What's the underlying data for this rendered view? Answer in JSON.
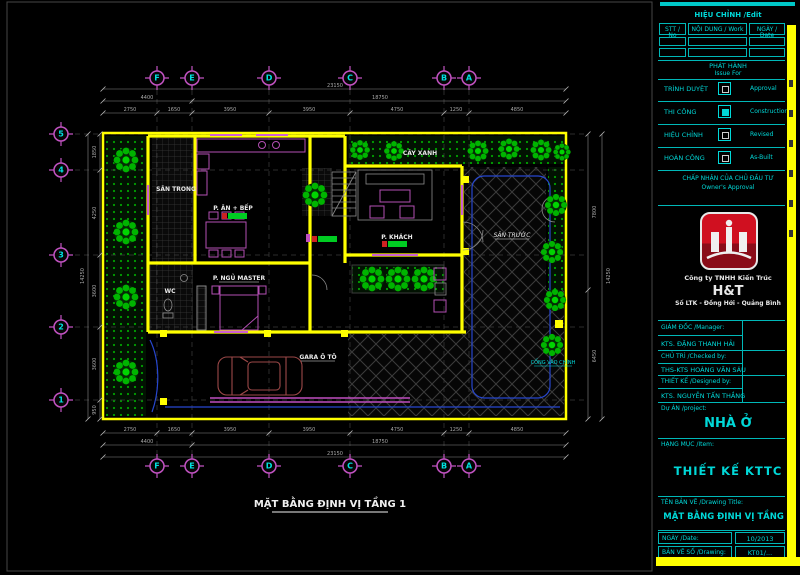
{
  "titleblock": {
    "edit_header": "HIỆU CHỈNH /Edit",
    "table": {
      "headers": [
        "STT / No",
        "NỘI DUNG / Work",
        "NGÀY / Date"
      ]
    },
    "issue": {
      "vi": "PHÁT HÀNH",
      "en": "Issue For"
    },
    "issue_rows": [
      {
        "vi": "TRÌNH DUYỆT",
        "en": "Approval"
      },
      {
        "vi": "THI CÔNG",
        "en": "Construction"
      },
      {
        "vi": "HIỆU CHỈNH",
        "en": "Revised"
      },
      {
        "vi": "HOÀN CÔNG",
        "en": "As-Built"
      }
    ],
    "approval": {
      "vi": "CHẤP NHẬN CỦA CHỦ ĐẦU TƯ",
      "en": "Owner's Approval"
    },
    "company": {
      "line1": "Công ty TNHH Kiến Trúc",
      "brand": "H&T",
      "line2": "Số LTK - Đồng Hới - Quảng Bình"
    },
    "staff": [
      {
        "role": "GIÁM ĐỐC /Manager:",
        "name": "KTS. ĐẶNG THANH HẢI"
      },
      {
        "role": "CHỦ TRÌ /Checked by:",
        "name": "THS-KTS HOÀNG VĂN SÁU"
      },
      {
        "role": "THIẾT KẾ /Designed by:",
        "name": "KTS. NGUYỄN TẤN THẮNG"
      }
    ],
    "project": {
      "label": "Dự ÁN /project:",
      "value": "NHÀ Ở"
    },
    "item": {
      "label": "HẠNG MỤC /Item:",
      "value": "THIẾT KẾ KTTC"
    },
    "drawing": {
      "label": "TÊN BẢN VẼ /Drawing Title:",
      "value": "MẶT BẰNG ĐỊNH VỊ TẦNG 1"
    },
    "date": {
      "label": "NGÀY /Date:",
      "value": "10/2013"
    },
    "number": {
      "label": "BẢN VẼ SỐ /Drawing:",
      "value": "KT01/..."
    }
  },
  "plan": {
    "caption": "MẶT BẰNG ĐỊNH VỊ TẦNG 1",
    "grid_cols": [
      "F",
      "E",
      "D",
      "C",
      "B",
      "A"
    ],
    "grid_rows": [
      "5",
      "4",
      "3",
      "2",
      "1"
    ],
    "labels": {
      "kitchen": "P. ĂN + BẾP",
      "living": "P. KHÁCH",
      "bedroom": "P. NGỦ MASTER",
      "wc": "WC",
      "garage": "GARA Ô TÔ",
      "front_yard": "SÂN TRƯỚC",
      "inner_yard": "SÂN TRONG",
      "greenery": "CÂY XANH",
      "main_gate": "CỔNG VÀO CHÍNH"
    },
    "dims": {
      "top_bays": [
        "2750",
        "1650",
        "3950",
        "3950",
        "4750",
        "1250",
        "4850"
      ],
      "top_mid": [
        "4400",
        "18750"
      ],
      "top_total": "23150",
      "left_bays": [
        "1850",
        "4250",
        "3600",
        "3600",
        "950"
      ],
      "left_total": "14250",
      "right_segs": [
        "7800",
        "6450"
      ],
      "right_total": "14250"
    }
  },
  "colors": {
    "accent_cyan": "#00d8d8",
    "frame_yellow": "#ffff00",
    "grid_magenta": "#c353c3",
    "tree_green": "#00b400",
    "furniture_magenta": "#b050b0",
    "car_maroon": "#9c4848",
    "area_chip_green": "#00cc22",
    "area_chip_red": "#cc2222"
  }
}
